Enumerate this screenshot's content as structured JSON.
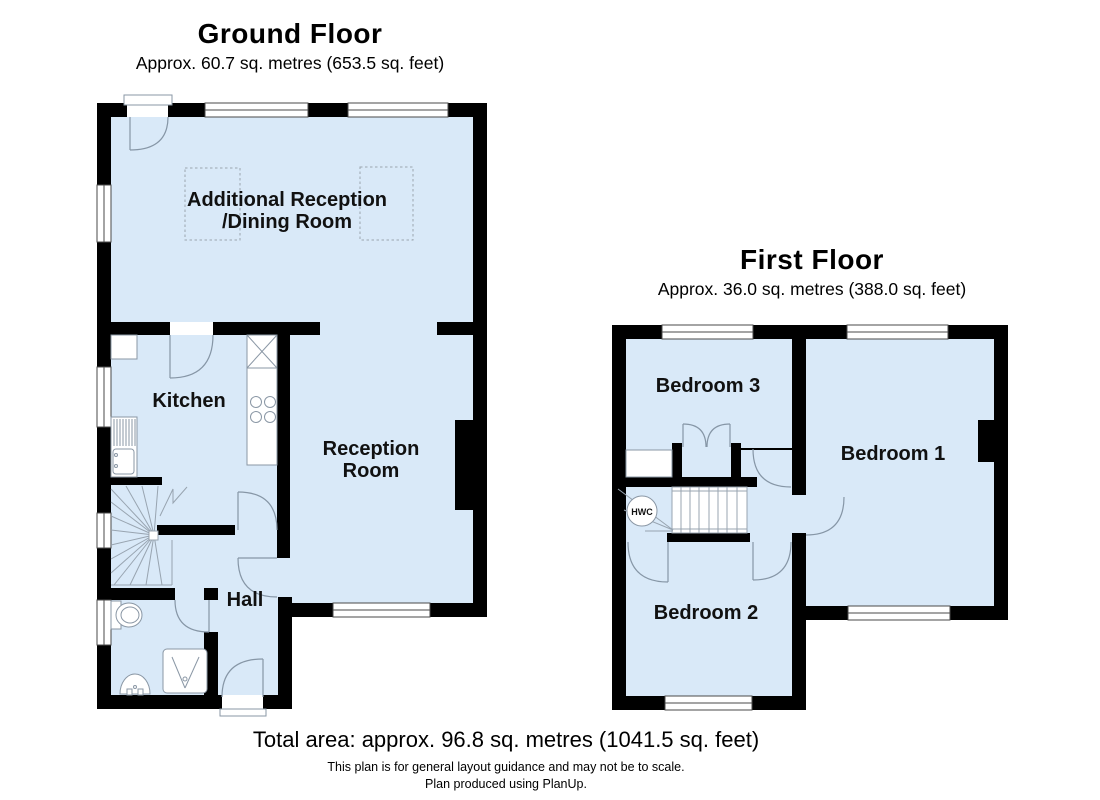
{
  "ground_floor": {
    "title": "Ground Floor",
    "area_label": "Approx. 60.7 sq. metres (653.5 sq. feet)",
    "rooms": {
      "additional_reception_line1": "Additional Reception",
      "additional_reception_line2": "/Dining Room",
      "kitchen": "Kitchen",
      "reception_line1": "Reception",
      "reception_line2": "Room",
      "hall": "Hall"
    },
    "fixtures": [
      "winder-staircase",
      "kitchen-sink",
      "worktop",
      "hob",
      "toilet",
      "shower",
      "basin"
    ]
  },
  "first_floor": {
    "title": "First Floor",
    "area_label": "Approx. 36.0 sq. metres (388.0 sq. feet)",
    "rooms": {
      "bedroom_1": "Bedroom 1",
      "bedroom_2": "Bedroom 2",
      "bedroom_3": "Bedroom 3",
      "hwc_label": "HWC"
    },
    "fixtures": [
      "staircase",
      "hot-water-cylinder",
      "built-in-cupboard",
      "double-door-closet"
    ]
  },
  "footer": {
    "total_area": "Total area: approx. 96.8 sq. metres (1041.5 sq. feet)",
    "disclaimer": "This plan is for general layout guidance and may not be to scale.",
    "credit": "Plan produced using PlanUp."
  },
  "colors": {
    "floor_fill": "#d9e9f8",
    "wall": "#000000",
    "detail_line": "#8696a6"
  }
}
